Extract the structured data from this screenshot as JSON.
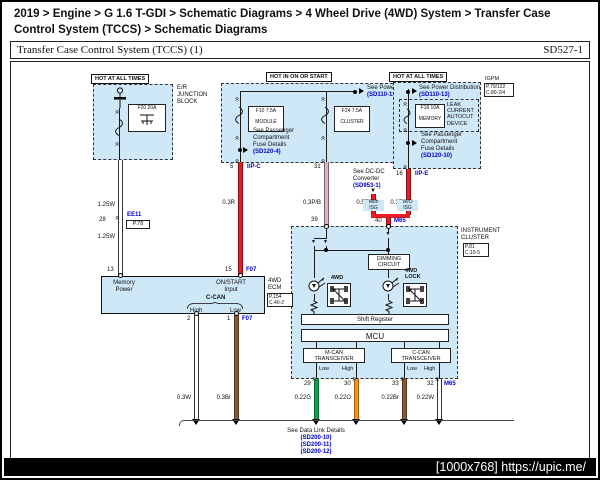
{
  "colors": {
    "panel_fill": "#cfe8f7",
    "link_blue": "#0000cd",
    "wire_red": "#ed1c24",
    "wire_pink": "#f2a9c7",
    "wire_green": "#0f9d4e",
    "wire_orange": "#f7941d",
    "wire_brown": "#8a5a33",
    "wire_white": "#ffffff"
  },
  "icons": {
    "chevron": "«",
    "diode": "▼"
  },
  "page": {
    "breadcrumb": "2019 > Engine > G 1.6 T-GDI > Schematic Diagrams > 4 Wheel Drive (4WD) System > Transfer Case Control System (TCCS) > Schematic Diagrams",
    "watermark": "[1000x768] https://upic.me/"
  },
  "header": {
    "title": "Transfer Case Control System (TCCS) (1)",
    "code": "SD527-1"
  },
  "left": {
    "hot": "HOT AT ALL TIMES",
    "block": [
      "E/R",
      "JUNCTION",
      "BLOCK"
    ],
    "fuse": "F20 20A",
    "wire_upper": "1.25W",
    "wire_lower": "1.25W",
    "pin_28": "28",
    "conn": "EE11",
    "conn_ref": "P.78",
    "pin_13": "13"
  },
  "mid": {
    "hot": "HOT IN ON OR START",
    "see_power": "See Power Distribution",
    "see_power_ref": "(SD110-12)",
    "fuse1": "F10 7.5A",
    "fuse1_name": "MODULE",
    "fuse2": "F24 7.5A",
    "fuse2_name": "CLUSTER",
    "see_fuse": [
      "See Passenger",
      "Compartment",
      "Fuse Details"
    ],
    "see_fuse_ref": "(SD120-4)",
    "pin_5": "5",
    "conn": "I/P-C",
    "wire_red": "0.3R",
    "pin_31": "31",
    "wire_pink": "0.3P/B",
    "pin_39": "39"
  },
  "right": {
    "hot": "HOT AT ALL TIMES",
    "see_power": "See Power Distribution",
    "see_power_ref": "(SD110-13)",
    "igpm": "IGPM",
    "igpm_ref1": "P.79/122",
    "igpm_ref2": "C.80-2/4",
    "device": [
      "LEAK",
      "CURRENT",
      "AUTOCUT",
      "DEVICE"
    ],
    "fuse": "F18 10A",
    "fuse_name": "MEMORY",
    "see_fuse": [
      "See Passenger",
      "Compartment",
      "Fuse Details"
    ],
    "see_fuse_ref": "(SD120-10)",
    "pin_16": "16",
    "conn": "I/P-E",
    "wire_red": "0.3R",
    "dcdc": [
      "See DC-DC",
      "Converter"
    ],
    "dcdc_ref": "(SD953-1)",
    "wire_r05": "0.5R",
    "with_isg": [
      "With",
      "ISG"
    ],
    "wo_isg": [
      "W/O",
      "ISG"
    ],
    "pin_40": "40",
    "conn_m65": "M65"
  },
  "ecm": {
    "name": [
      "4WD",
      "ECM"
    ],
    "ref1": "P.154",
    "ref2": "C.40-2",
    "memory_power": [
      "Memory",
      "Power"
    ],
    "onstart": [
      "ON/START",
      "Input"
    ],
    "pin_15": "15",
    "conn_f07": "F07",
    "ccan": "C-CAN",
    "high": "High",
    "low": "Low",
    "pin_2": "2",
    "pin_1": "1",
    "conn_f07b": "F07",
    "wire_white": "0.3W",
    "wire_brown": "0.3Br"
  },
  "cluster": {
    "name": [
      "INSTRUMENT",
      "CLUSTER"
    ],
    "ref1": "P.81",
    "ref2": "C.10-5",
    "dimming": [
      "DIMMING",
      "CIRCUIT"
    ],
    "ind1": "4WD",
    "ind2": [
      "4WD",
      "LOCK"
    ],
    "shift": "Shift Register",
    "mcu": "MCU",
    "mcan": [
      "M-CAN",
      "TRANSCEIVER"
    ],
    "ccan": [
      "C-CAN",
      "TRANSCEIVER"
    ],
    "low": "Low",
    "high": "High",
    "pin_29": "29",
    "pin_30": "30",
    "pin_33": "33",
    "pin_32": "32",
    "conn_m65": "M65",
    "wire_g": "0.22G",
    "wire_o": "0.22O",
    "wire_br": "0.22Br",
    "wire_w": "0.22W"
  },
  "datalink": {
    "see": "See Data Link Details",
    "refs": [
      "(SD200-10)",
      "(SD200-11)",
      "(SD200-12)"
    ]
  }
}
